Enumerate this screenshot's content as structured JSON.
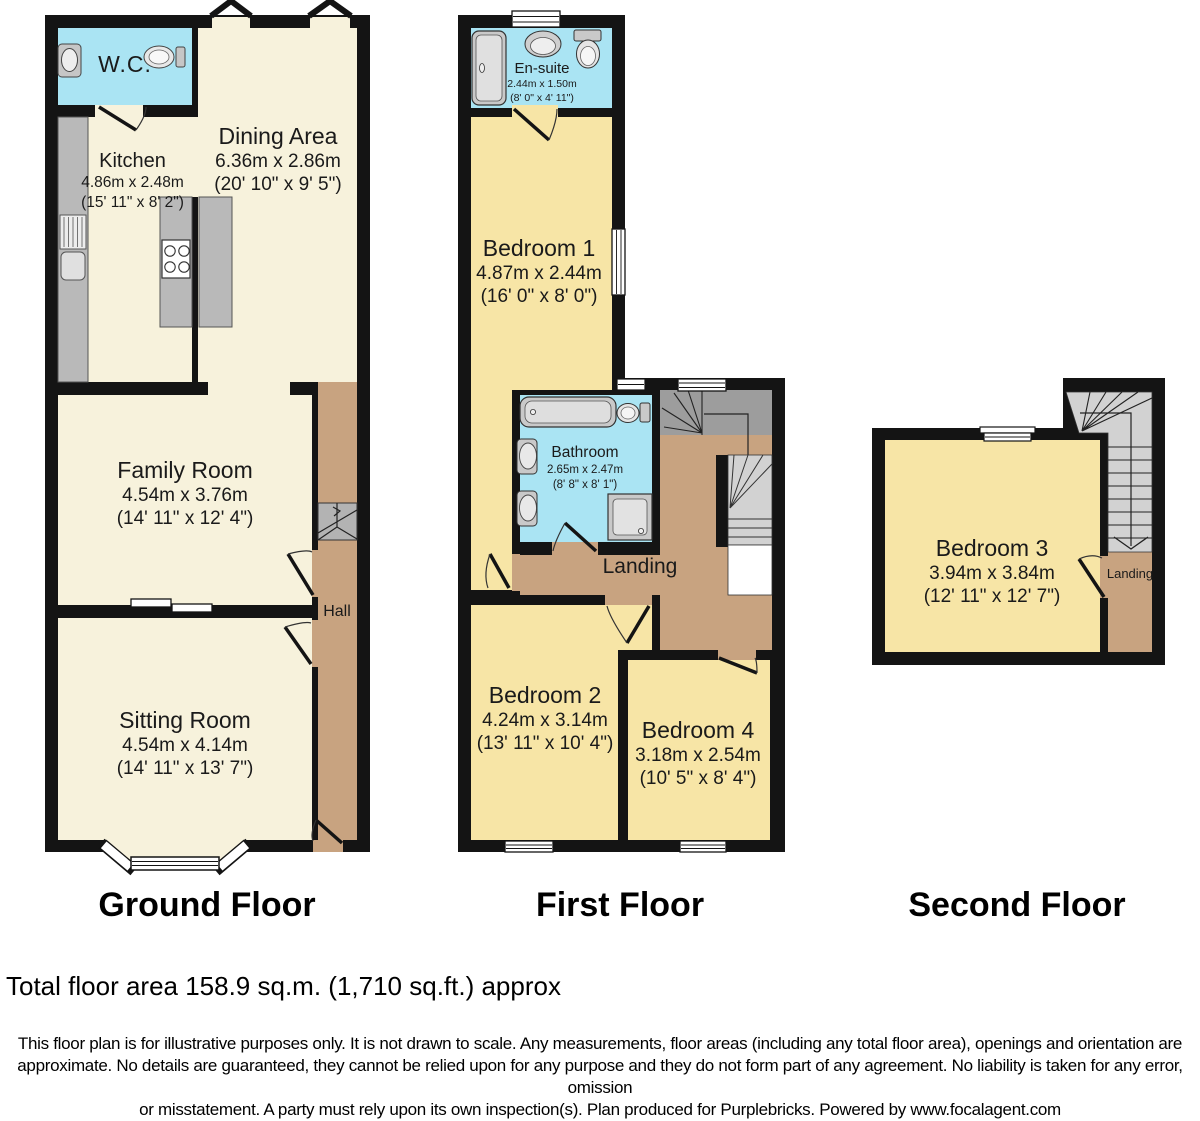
{
  "plan": {
    "ground": {
      "title": "Ground Floor",
      "wc": {
        "name": "W.C."
      },
      "kitchen": {
        "name": "Kitchen",
        "m": "4.86m x 2.48m",
        "ft": "(15' 11\" x 8' 2\")"
      },
      "dining": {
        "name": "Dining Area",
        "m": "6.36m x 2.86m",
        "ft": "(20' 10\" x 9' 5\")"
      },
      "family": {
        "name": "Family Room",
        "m": "4.54m x 3.76m",
        "ft": "(14' 11\" x 12' 4\")"
      },
      "hall": {
        "name": "Hall"
      },
      "sitting": {
        "name": "Sitting Room",
        "m": "4.54m x 4.14m",
        "ft": "(14' 11\" x 13' 7\")"
      }
    },
    "first": {
      "title": "First Floor",
      "ensuite": {
        "name": "En-suite",
        "m": "2.44m x 1.50m",
        "ft": "(8' 0\" x 4' 11\")"
      },
      "bedroom1": {
        "name": "Bedroom 1",
        "m": "4.87m x 2.44m",
        "ft": "(16' 0\" x 8' 0\")"
      },
      "bathroom": {
        "name": "Bathroom",
        "m": "2.65m x 2.47m",
        "ft": "(8' 8\" x 8' 1\")"
      },
      "landing": {
        "name": "Landing"
      },
      "bedroom2": {
        "name": "Bedroom 2",
        "m": "4.24m x 3.14m",
        "ft": "(13' 11\" x 10' 4\")"
      },
      "bedroom4": {
        "name": "Bedroom 4",
        "m": "3.18m x 2.54m",
        "ft": "(10' 5\" x 8' 4\")"
      }
    },
    "second": {
      "title": "Second Floor",
      "bedroom3": {
        "name": "Bedroom 3",
        "m": "3.94m x 3.84m",
        "ft": "(12' 11\" x 12' 7\")"
      },
      "landing": {
        "name": "Landing"
      }
    }
  },
  "footer": {
    "total_area": "Total floor area 158.9 sq.m. (1,710 sq.ft.) approx",
    "disclaimer_lines": [
      "This floor plan is for illustrative purposes only. It is not drawn to scale. Any measurements, floor areas (including any total floor area), openings and orientation are",
      "approximate. No details are guaranteed, they cannot be relied upon for any purpose and they do not form part of any agreement. No liability is taken for any error, omission",
      "or misstatement. A party must rely upon its own inspection(s). Plan produced for Purplebricks. Powered by www.focalagent.com"
    ]
  },
  "colors": {
    "wall": "#141414",
    "room_cream": "#F7F2DC",
    "room_yellow": "#F7E5A6",
    "wet_room_cyan": "#AAE4F3",
    "hall_tan": "#C8A380",
    "stairs_gray": "#B3B3B3",
    "stairs_dark_gray": "#9D9D9D",
    "stairs_light_gray": "#D2D2D2",
    "counter_gray": "#B9B9B9"
  }
}
